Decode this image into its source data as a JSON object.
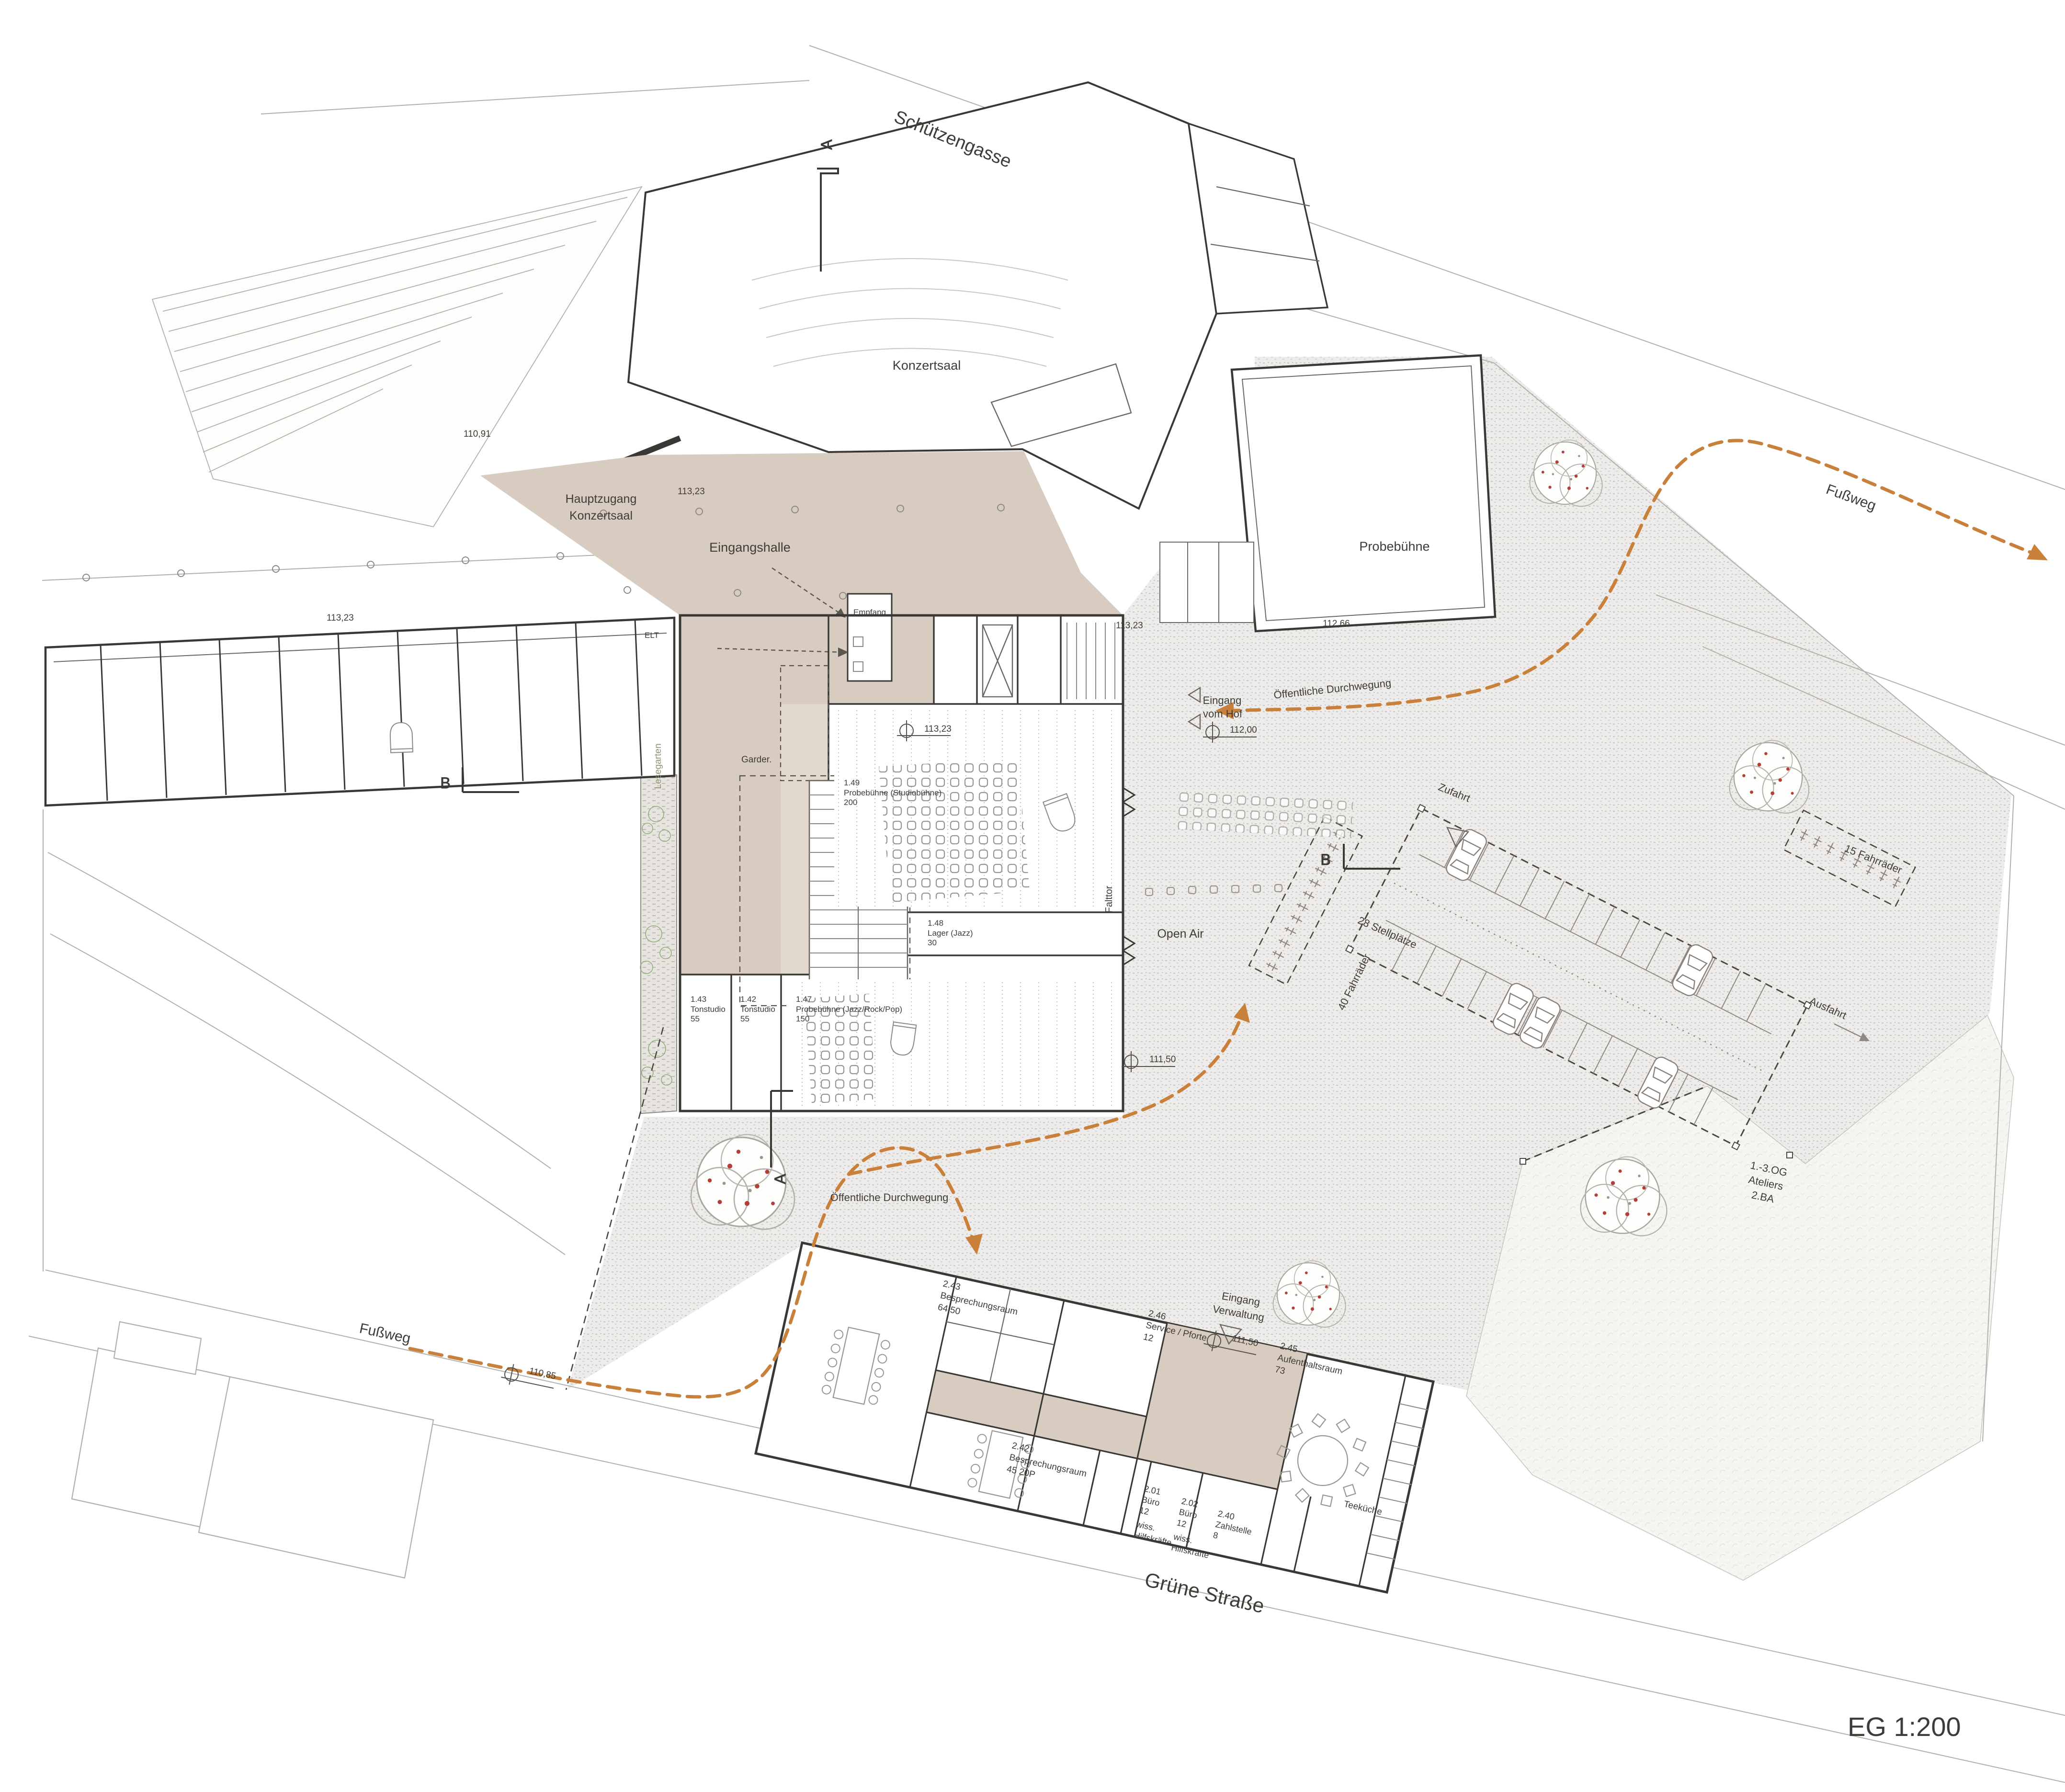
{
  "scale_label": "EG 1:200",
  "streets": {
    "schuetzengasse": "Schützengasse",
    "gruene_strasse": "Grüne Straße",
    "fussweg": "Fußweg"
  },
  "site": {
    "open_air": "Open Air",
    "public_route": "Öffentliche Durchwegung",
    "courtyard_entrance_l1": "Eingang",
    "courtyard_entrance_l2": "vom Hof",
    "admin_entrance_l1": "Eingang",
    "admin_entrance_l2": "Verwaltung",
    "main_access_l1": "Hauptzugang",
    "main_access_l2": "Konzertsaal",
    "ateliers_l1": "1.-3.OG",
    "ateliers_l2": "Ateliers",
    "ateliers_l3": "2.BA",
    "parking_access": "Zufahrt",
    "parking_exit": "Ausfahrt",
    "parking_stalls": "28 Stellplätze",
    "bikes_40": "40 Fahrräder",
    "bikes_15": "15 Fahrräder"
  },
  "buildings": {
    "konzertsaal": "Konzertsaal",
    "probebuehne": "Probebühne",
    "eingangshalle": "Eingangshalle",
    "empfang": "Empfang",
    "garderobe": "Garder.",
    "elt": "ELT",
    "lesegarten": "Lesegarten",
    "falttor": "Falttor",
    "teekueche": "Teeküche"
  },
  "rooms": {
    "r149": {
      "id": "1.49",
      "name": "Probebühne (Studiobühne)",
      "area": "200"
    },
    "r148": {
      "id": "1.48",
      "name": "Lager (Jazz)",
      "area": "30"
    },
    "r147": {
      "id": "1.47",
      "name": "Probebühne (Jazz/Rock/Pop)",
      "area": "150"
    },
    "r143": {
      "id": "1.43",
      "name": "Tonstudio",
      "area": "55"
    },
    "r142": {
      "id": "1.42",
      "name": "Tonstudio",
      "area": "55"
    },
    "r243": {
      "id": "2.43",
      "name": "Besprechungsraum",
      "area": "64,50"
    },
    "r246": {
      "id": "2.46",
      "name": "Service / Pforte",
      "area": "12"
    },
    "r245": {
      "id": "2.45",
      "name": "Aufenthaltsraum",
      "area": "73"
    },
    "r242": {
      "id": "2.42",
      "name": "Besprechungsraum",
      "area": "45  20P"
    },
    "r201": {
      "id": "2.01",
      "name": "Büro",
      "area": "12",
      "staff_l1": "wiss.",
      "staff_l2": "Hilfskräfte"
    },
    "r202": {
      "id": "2.02",
      "name": "Büro",
      "area": "12",
      "staff_l1": "wiss.",
      "staff_l2": "Hilfskräfte"
    },
    "r240": {
      "id": "2.40",
      "name": "Zahlstelle",
      "area": "8"
    }
  },
  "levels": {
    "v11091": "110,91",
    "v11323": "113,23",
    "v11266": "112,66",
    "v11200": "112,00",
    "v11150": "111,50",
    "v11085": "110,85"
  },
  "sections": {
    "a": "A",
    "b": "B"
  },
  "colors": {
    "floor_beige": "#d8ccc0",
    "accent_orange": "#c8803b",
    "tree_red": "#b34038",
    "wall_dark": "#3a3835",
    "context_line": "#b3afaa"
  }
}
